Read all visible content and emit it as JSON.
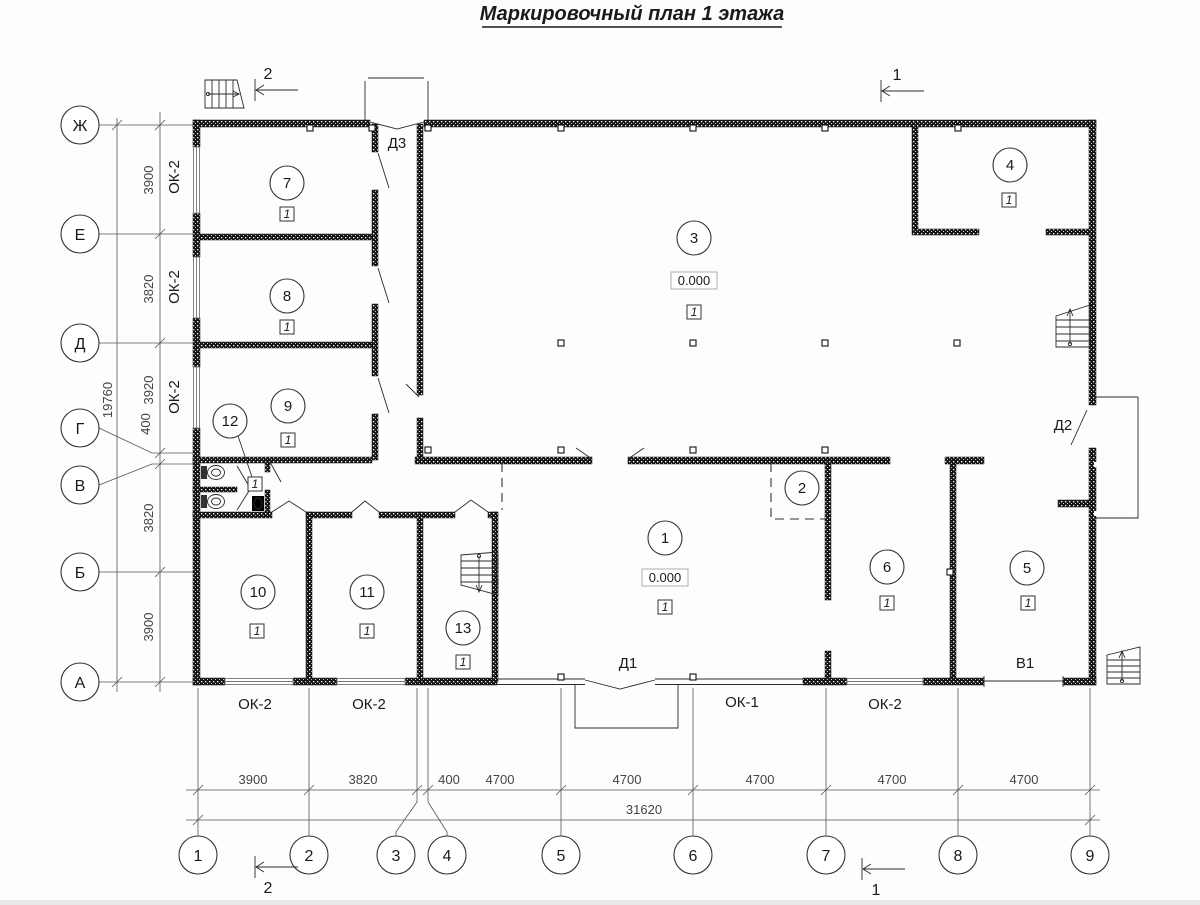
{
  "title": "Маркировочный план 1 этажа",
  "axes": {
    "rows": [
      "Ж",
      "Е",
      "Д",
      "Г",
      "В",
      "Б",
      "А"
    ],
    "cols": [
      "1",
      "2",
      "3",
      "4",
      "5",
      "6",
      "7",
      "8",
      "9"
    ]
  },
  "dim_left": {
    "segments": [
      "3900",
      "3820",
      "3920",
      "400",
      "3820",
      "3900"
    ],
    "total": "19760"
  },
  "dim_bottom": {
    "segments": [
      "3900",
      "3820",
      "400",
      "4700",
      "4700",
      "4700",
      "4700",
      "4700"
    ],
    "total": "31620"
  },
  "rooms": {
    "r1": {
      "number": "1",
      "elevation": "0.000",
      "finish": "1"
    },
    "r2": {
      "number": "2"
    },
    "r3": {
      "number": "3",
      "elevation": "0.000",
      "finish": "1"
    },
    "r4": {
      "number": "4",
      "finish": "1"
    },
    "r5": {
      "number": "5",
      "finish": "1"
    },
    "r6": {
      "number": "6",
      "finish": "1"
    },
    "r7": {
      "number": "7",
      "finish": "1"
    },
    "r8": {
      "number": "8",
      "finish": "1"
    },
    "r9": {
      "number": "9",
      "finish": "1"
    },
    "r10": {
      "number": "10",
      "finish": "1"
    },
    "r11": {
      "number": "11",
      "finish": "1"
    },
    "r12": {
      "number": "12",
      "finish": "1"
    },
    "r13": {
      "number": "13",
      "finish": "1"
    }
  },
  "doors": {
    "d1": "Д1",
    "d2": "Д2",
    "d3": "Д3"
  },
  "windows": {
    "ok1": "ОК-1",
    "ok2": "ОК-2",
    "v1": "В1"
  },
  "sections": {
    "s1": "1",
    "s2": "2"
  }
}
